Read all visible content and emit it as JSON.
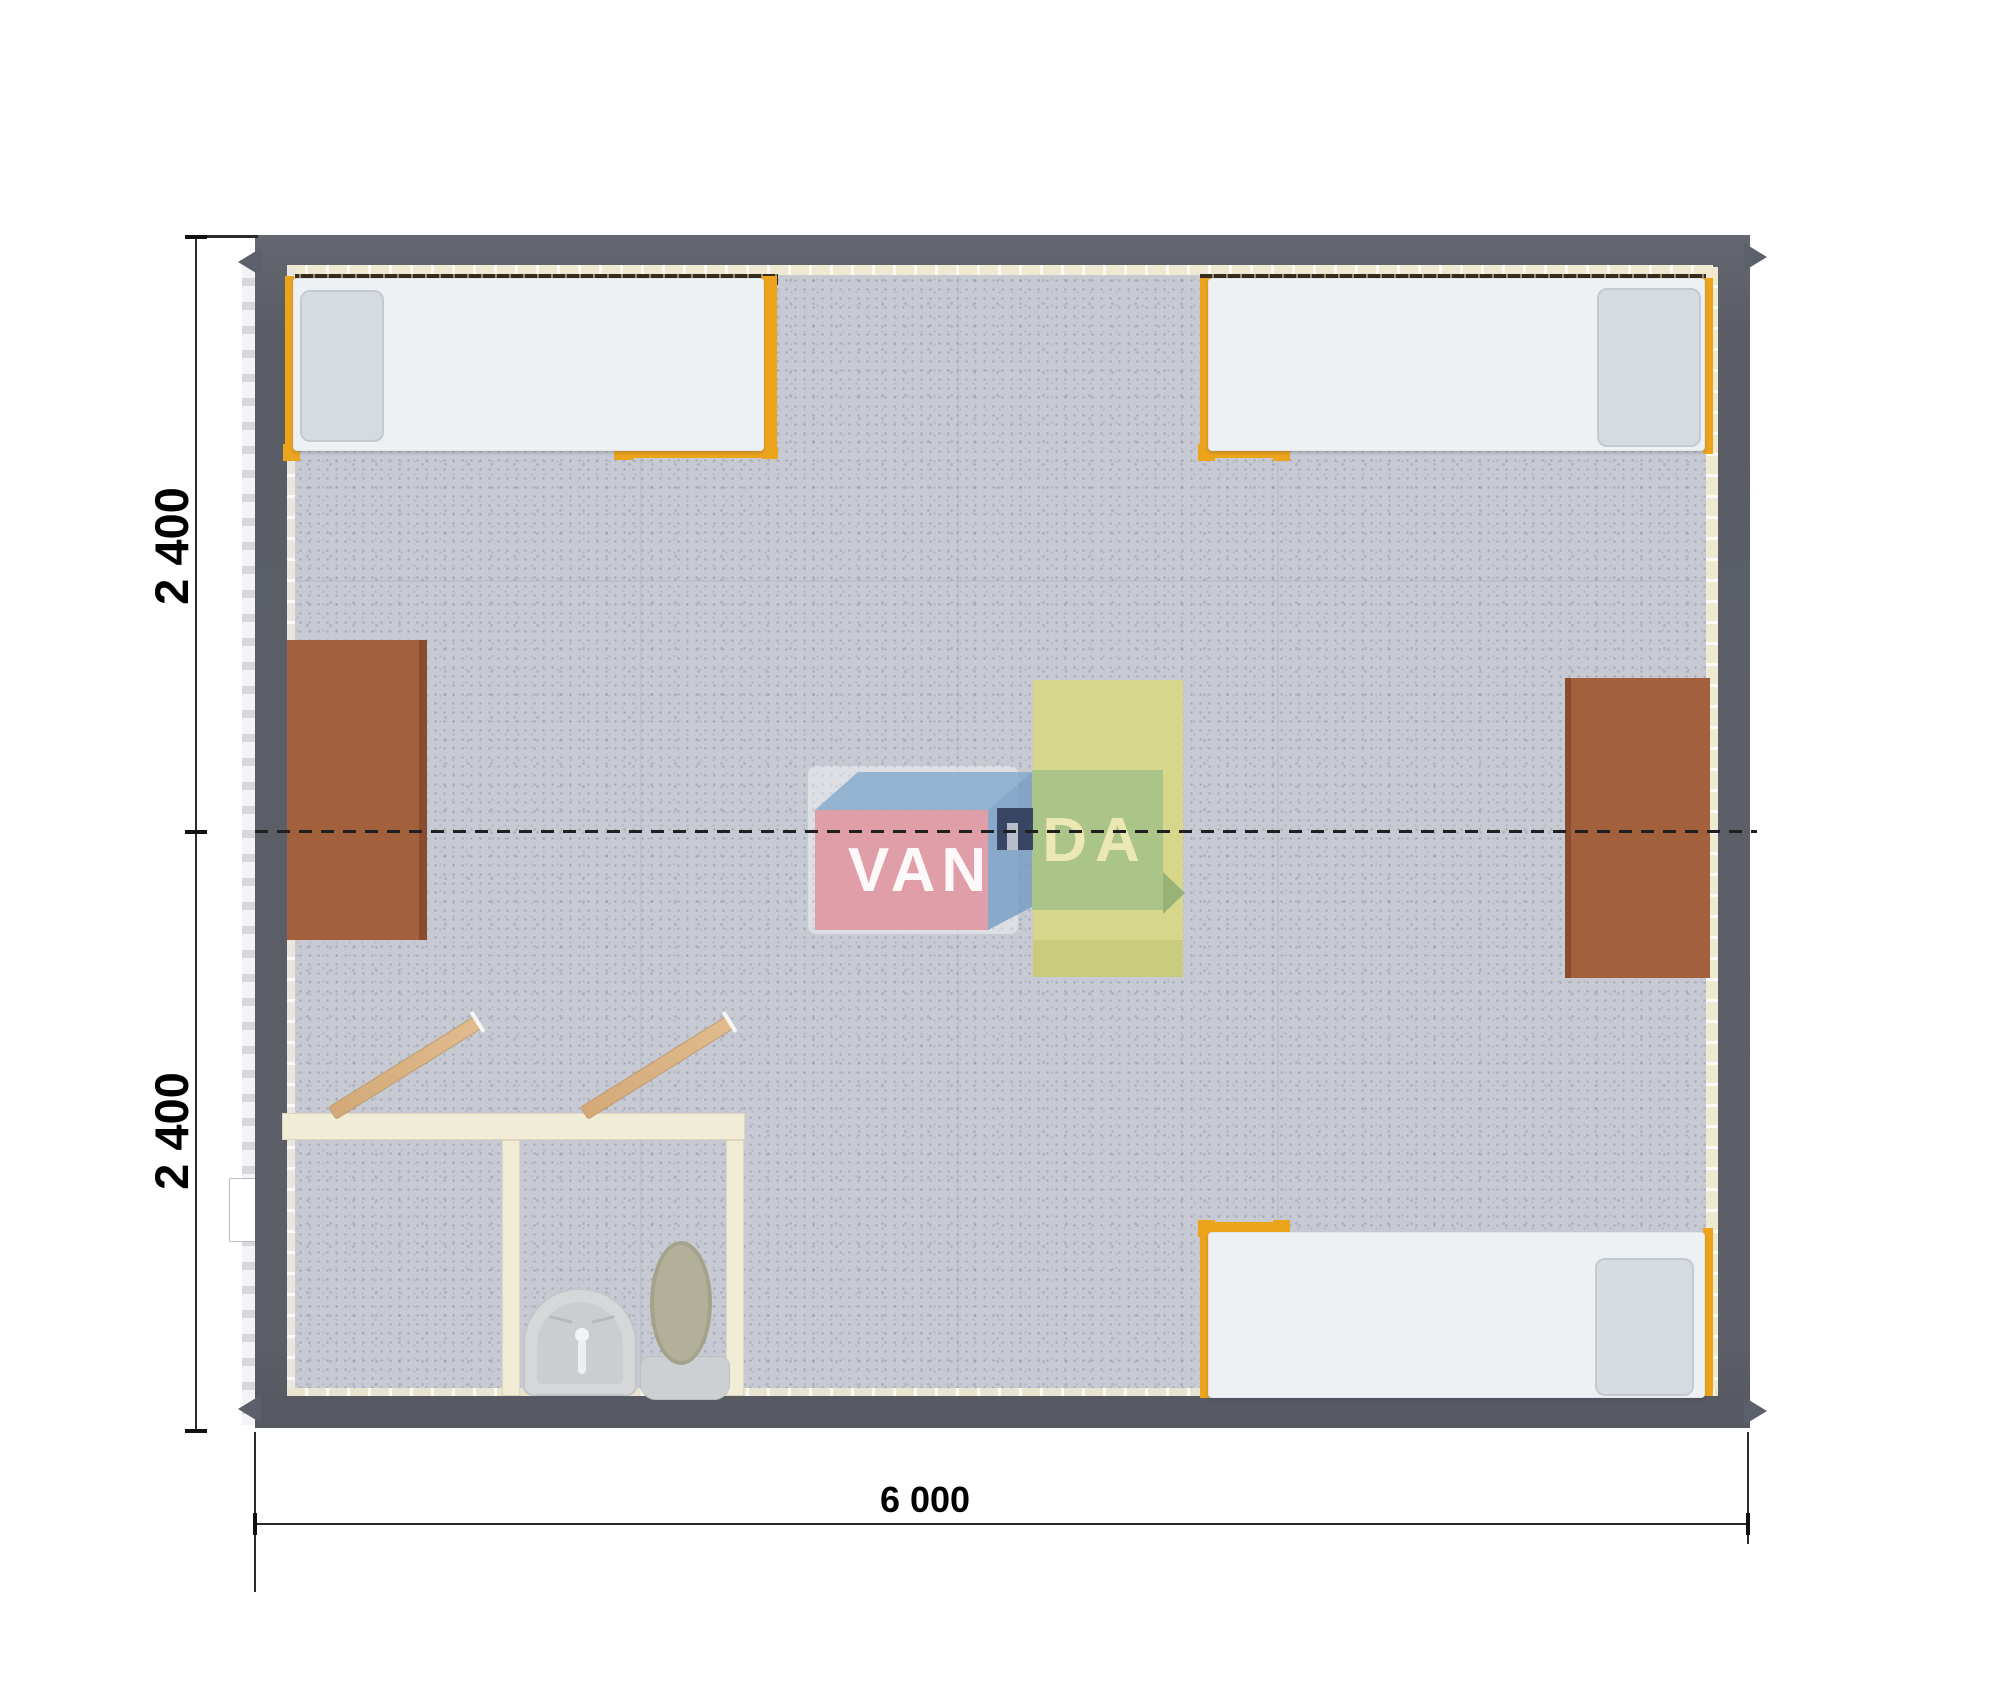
{
  "figure": {
    "type": "modular-cabin-floor-plan",
    "units": "mm"
  },
  "dimensions": {
    "height_top": "2 400",
    "height_bottom": "2 400",
    "width": "6 000"
  },
  "watermark": {
    "left": "VAN",
    "right": "DA"
  },
  "colors": {
    "wall_gray": "#5c606a",
    "floor_gray": "#c7cad3",
    "frame_orange": "#eda41d",
    "desk_brown": "#a3603d",
    "table_yellow": "#d6d78b",
    "bathroom_wall_cream": "#f1ecd5",
    "door_wood": "#d9b184",
    "logo_pink": "#e094a0",
    "logo_blue": "#87acce",
    "logo_green": "#94ba86",
    "logo_navy": "#34405e"
  }
}
